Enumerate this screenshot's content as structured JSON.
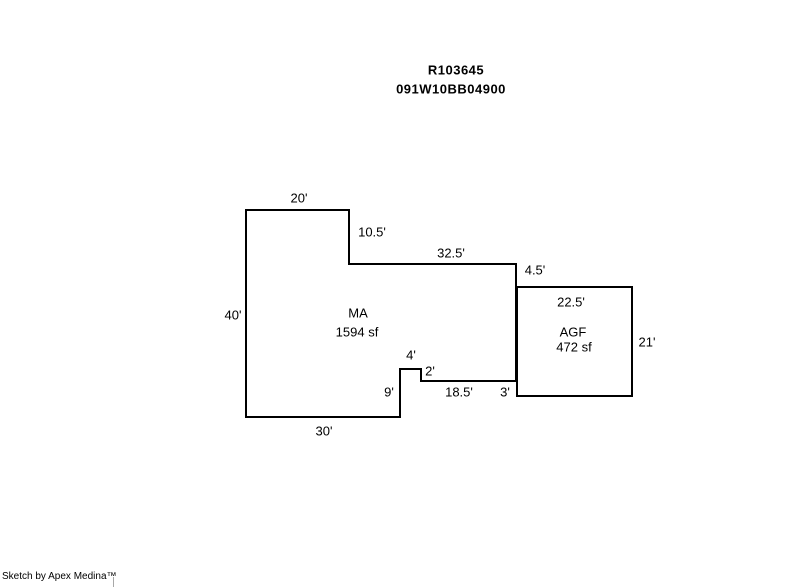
{
  "canvas": {
    "background": "#ffffff",
    "line_color": "#000000"
  },
  "header": {
    "line1": "R103645",
    "line2": "091W10BB04900"
  },
  "sketch": {
    "areas": [
      {
        "code": "MA",
        "size": "1594 sf"
      },
      {
        "code": "AGF",
        "size": "472 sf"
      }
    ],
    "dimensions": [
      "20'",
      "10.5'",
      "32.5'",
      "4.5'",
      "22.5'",
      "40'",
      "21'",
      "4'",
      "2'",
      "9'",
      "18.5'",
      "3'",
      "30'"
    ]
  },
  "footer": {
    "credit": "Sketch by Apex Medina™"
  }
}
